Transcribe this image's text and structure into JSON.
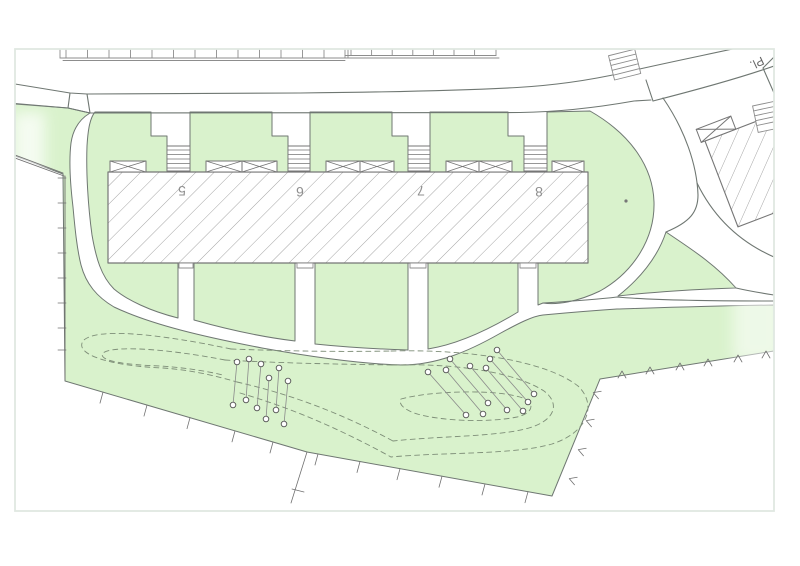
{
  "title": "site-plan",
  "street": {
    "label": "Pl."
  },
  "building": {
    "units": [
      {
        "label": "5",
        "x": 182,
        "y": 191
      },
      {
        "label": "6",
        "x": 300,
        "y": 192
      },
      {
        "label": "7",
        "x": 421,
        "y": 191
      },
      {
        "label": "8",
        "x": 539,
        "y": 192
      }
    ]
  },
  "colors": {
    "green": "#d9f2cc",
    "outline": "#6f7772",
    "building_line": "#767676",
    "hatch": "#9b9b9b",
    "dashed_contour": "#7e8e78",
    "parking_line": "#8d8d8d",
    "survey_line": "#707070",
    "tree_line": "#8a8a8a",
    "tree_stroke": "#4f4f4f",
    "border": "#e0e8e2",
    "label_text": "#8f8f8f"
  },
  "plantings": {
    "cluster_a_pairs": [
      [
        237,
        362,
        233,
        405
      ],
      [
        249,
        359,
        246,
        400
      ],
      [
        261,
        364,
        257,
        408
      ],
      [
        269,
        378,
        266,
        419
      ],
      [
        279,
        368,
        276,
        410
      ],
      [
        288,
        381,
        284,
        424
      ]
    ],
    "cluster_b_pairs": [
      [
        428,
        372,
        466,
        415
      ],
      [
        446,
        370,
        483,
        414
      ],
      [
        450,
        359,
        488,
        403
      ],
      [
        470,
        366,
        507,
        410
      ],
      [
        486,
        368,
        523,
        411
      ],
      [
        490,
        359,
        528,
        402
      ],
      [
        497,
        350,
        534,
        394
      ]
    ],
    "tree_radius": 2.8
  },
  "survey": {
    "sw_tick_xs": [
      103,
      147,
      190,
      235,
      273,
      318,
      360,
      400,
      442,
      485,
      528
    ],
    "sw_segment_1": {
      "x1": 65,
      "y1": 381,
      "x2": 307,
      "y2": 452
    },
    "sw_segment_2": {
      "x1": 307,
      "y1": 452,
      "x2": 552,
      "y2": 496
    },
    "se_chevrons": [
      [
        573,
        480
      ],
      [
        582,
        451
      ],
      [
        590,
        422
      ],
      [
        597,
        394
      ]
    ],
    "ne_chevrons": [
      [
        622,
        375
      ],
      [
        650,
        371
      ],
      [
        680,
        367
      ],
      [
        708,
        363
      ],
      [
        738,
        359
      ],
      [
        766,
        355
      ]
    ],
    "fence_tick_ys": [
      178,
      203,
      228,
      253,
      278,
      303,
      328,
      350
    ],
    "long_tick": {
      "x1": 307,
      "y1": 452,
      "x2": 291,
      "y2": 503,
      "bx1": 292,
      "by1": 489,
      "bx2": 304,
      "by2": 492
    }
  },
  "parking": {
    "row_a": {
      "x1": 60,
      "x2": 345,
      "step": 21.5,
      "top": 49,
      "bottom": 58
    },
    "row_b": {
      "x1": 345,
      "x2": 496,
      "step": 20.6,
      "top": 49,
      "bottom": 55.5
    }
  },
  "stairs": {
    "entry": [
      {
        "x": 167,
        "w": 23
      },
      {
        "x": 288,
        "w": 22
      },
      {
        "x": 408,
        "w": 22
      },
      {
        "x": 524,
        "w": 23
      }
    ],
    "tread_ys": [
      150,
      154.5,
      159,
      163.5,
      168
    ]
  }
}
